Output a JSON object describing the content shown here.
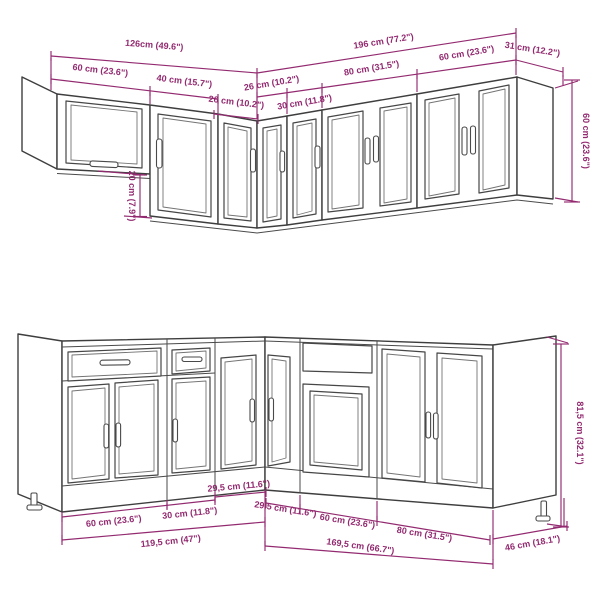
{
  "document": {
    "type": "kitchen-cabinet-set-dimension-diagram",
    "background": "#ffffff"
  },
  "colors": {
    "dimension": "#932a70",
    "drawing_line": "#3e3e3e"
  },
  "wall_section": {
    "name": "wall-cabinet-row",
    "dims": {
      "total_left": "126cm (49.6\")",
      "total_right": "196 cm (77.2\")",
      "cab_60_left": "60 cm (23.6\")",
      "cab_40": "40 cm (15.7\")",
      "cab_26_left": "26 cm (10.2\")",
      "cab_26_right": "26 cm (10.2\")",
      "cab_30": "30 cm (11.8\")",
      "cab_80": "80 cm (31.5\")",
      "cab_60_right": "60 cm (23.6\")",
      "return_depth": "31 cm (12.2\")",
      "height_offset": "20 cm (7.9\")",
      "height": "60 cm (23.6\")"
    }
  },
  "base_section": {
    "name": "base-cabinet-row",
    "dims": {
      "corner_left": "29,5 cm (11.6\")",
      "cab_60_left": "60 cm (23.6\")",
      "cab_30": "30 cm (11.8\")",
      "total_left": "119,5 cm (47\")",
      "corner_right": "29,5 cm (11.6\")",
      "cab_60_right": "60 cm (23.6\")",
      "cab_80": "80 cm (31.5\")",
      "total_right": "169,5 cm (66.7\")",
      "depth": "46 cm (18.1\")",
      "height": "81,5 cm (32.1\")"
    }
  }
}
